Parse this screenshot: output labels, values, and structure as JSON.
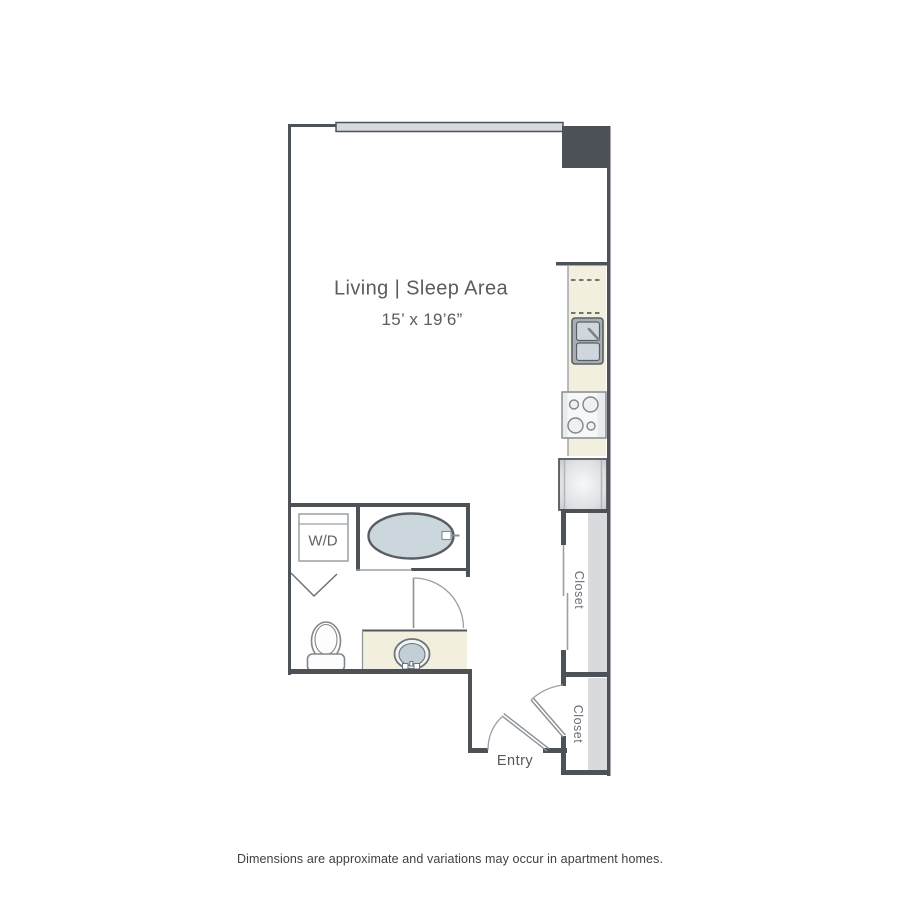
{
  "floor_plan": {
    "living_area": {
      "label": "Living | Sleep Area",
      "dimensions": "15’ x 19’6”"
    },
    "washer_dryer": {
      "label": "W/D"
    },
    "closet_upper": {
      "label": "Closet"
    },
    "closet_lower": {
      "label": "Closet"
    },
    "entry": {
      "label": "Entry"
    }
  },
  "disclaimer": "Dimensions are approximate and variations may occur in apartment homes.",
  "colors": {
    "wall": "#4d5258",
    "structural_column": "#4b5157",
    "window_fill": "#d6dadd",
    "counter_beige": "#f3efdf",
    "fixture_blue_gray": "#ccd6dd",
    "fixture_stroke": "#585d63",
    "light_stroke": "#9aa0a5",
    "closet_shading": "#d9dadd",
    "label_text": "#595c60",
    "disclaimer_text": "#3d4045"
  }
}
